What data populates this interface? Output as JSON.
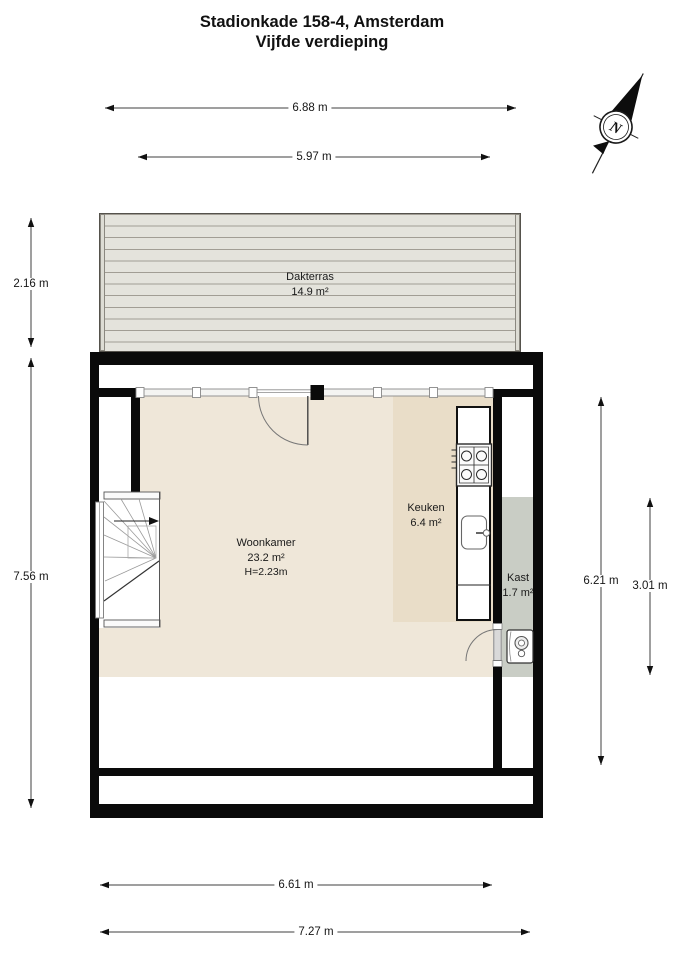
{
  "title": {
    "line1": "Stadionkade 158-4, Amsterdam",
    "line2": "Vijfde verdieping"
  },
  "compass": {
    "north_label": "N"
  },
  "rooms": {
    "dakterras": {
      "name": "Dakterras",
      "area": "14.9 m²"
    },
    "woonkamer": {
      "name": "Woonkamer",
      "area": "23.2 m²",
      "ceiling_height": "H=2.23m"
    },
    "keuken": {
      "name": "Keuken",
      "area": "6.4 m²"
    },
    "kast": {
      "name": "Kast",
      "area": "1.7 m²"
    }
  },
  "dimensions": {
    "top_outer": "6.88 m",
    "top_inner": "5.97 m",
    "left_upper": "2.16 m",
    "left_lower": "7.56 m",
    "right_outer": "6.21 m",
    "right_inner": "3.01 m",
    "bottom_inner": "6.61 m",
    "bottom_outer": "7.27 m"
  },
  "icons": {
    "compass": "north-arrow-icon",
    "kitchen_hob": "stove-icon",
    "kitchen_sink": "sink-icon",
    "closet_boiler": "water-heater-icon",
    "stairs": "winder-stairs-icon"
  },
  "colors": {
    "wall": "#0a0a0a",
    "floor_living": "#efe7d9",
    "floor_kitchen": "#e9ddc8",
    "floor_closet": "#c9cdc5",
    "terrace_deck": "#e4e3dc",
    "dimension_line": "#3f3f3f"
  }
}
